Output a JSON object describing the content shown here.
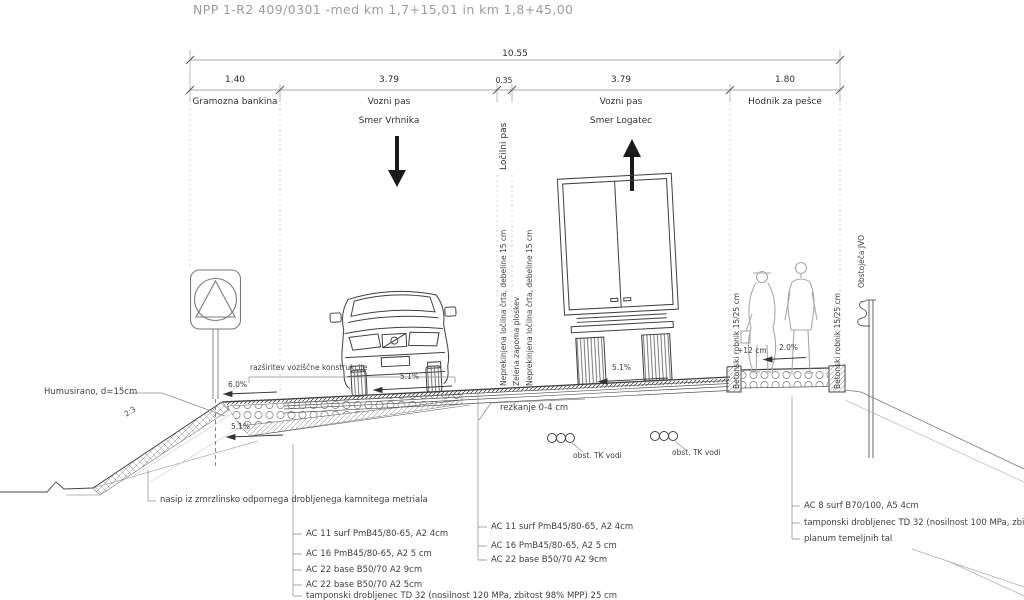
{
  "title": "NPP 1-R2 409/0301 -med km 1,7+15,01 in km 1,8+45,00",
  "dims": {
    "total": "10.55",
    "seg1": "1.40",
    "seg2": "3.79",
    "seg3": "0.35",
    "seg4": "3.79",
    "seg5": "1.80",
    "lbl1": "Gramozna bankina",
    "lbl2a": "Vozni pas",
    "lbl2b": "Smer Vrhnika",
    "lbl3": "Ločilni pas",
    "lbl4a": "Vozni pas",
    "lbl4b": "Smer Logatec",
    "lbl5": "Hodnik za pešce"
  },
  "markings": {
    "m1": "Neprekinjena ločilna črta, debeline 15 cm",
    "m2": "Zelena zaporna ploskev",
    "m3": "Neprekinjena ločilna črta, debeline 15 cm"
  },
  "slopes": {
    "bankina": "6.0%",
    "berm": "5.1%",
    "lane_left": "5.1%",
    "lane_right": "5.1%",
    "walk": "2.0%",
    "ratio": "2:3"
  },
  "curb": {
    "left": "Betonski robnik 15/25 cm",
    "right": "Betonski robnik 15/25 cm",
    "height": "+12 cm"
  },
  "jvo": "Obstoječa JVO",
  "notes": {
    "humus": "Humusirano, d=15cm",
    "widening": "razširitev voziščne konstrukcije",
    "fill": "nasip iz zmrzlinsko odpornega drobljenega kamnitega metriala",
    "milling": "rezkanje 0-4 cm",
    "tk_left": "obst. TK vodi",
    "tk_right": "obst. TK vodi"
  },
  "layers_left": [
    "AC 11 surf PmB45/80-65, A2 4cm",
    "AC 16 PmB45/80-65, A2 5 cm",
    "AC 22 base B50/70 A2 9cm",
    "AC 22 base B50/70 A2 5cm",
    "tamponski drobljenec TD 32 (nosilnost 120 MPa, zbitost 98% MPP) 25 cm"
  ],
  "layers_mid": [
    "AC 11 surf PmB45/80-65, A2 4cm",
    "AC 16 PmB45/80-65, A2 5 cm",
    "AC 22 base B50/70 A2 9cm"
  ],
  "layers_right": [
    "AC 8 surf B70/100, A5 4cm",
    "tamponski drobljenec TD 32 (nosilnost 100 MPa, zbitost 98% MPP) 20 cm",
    "planum temeljnih tal"
  ]
}
